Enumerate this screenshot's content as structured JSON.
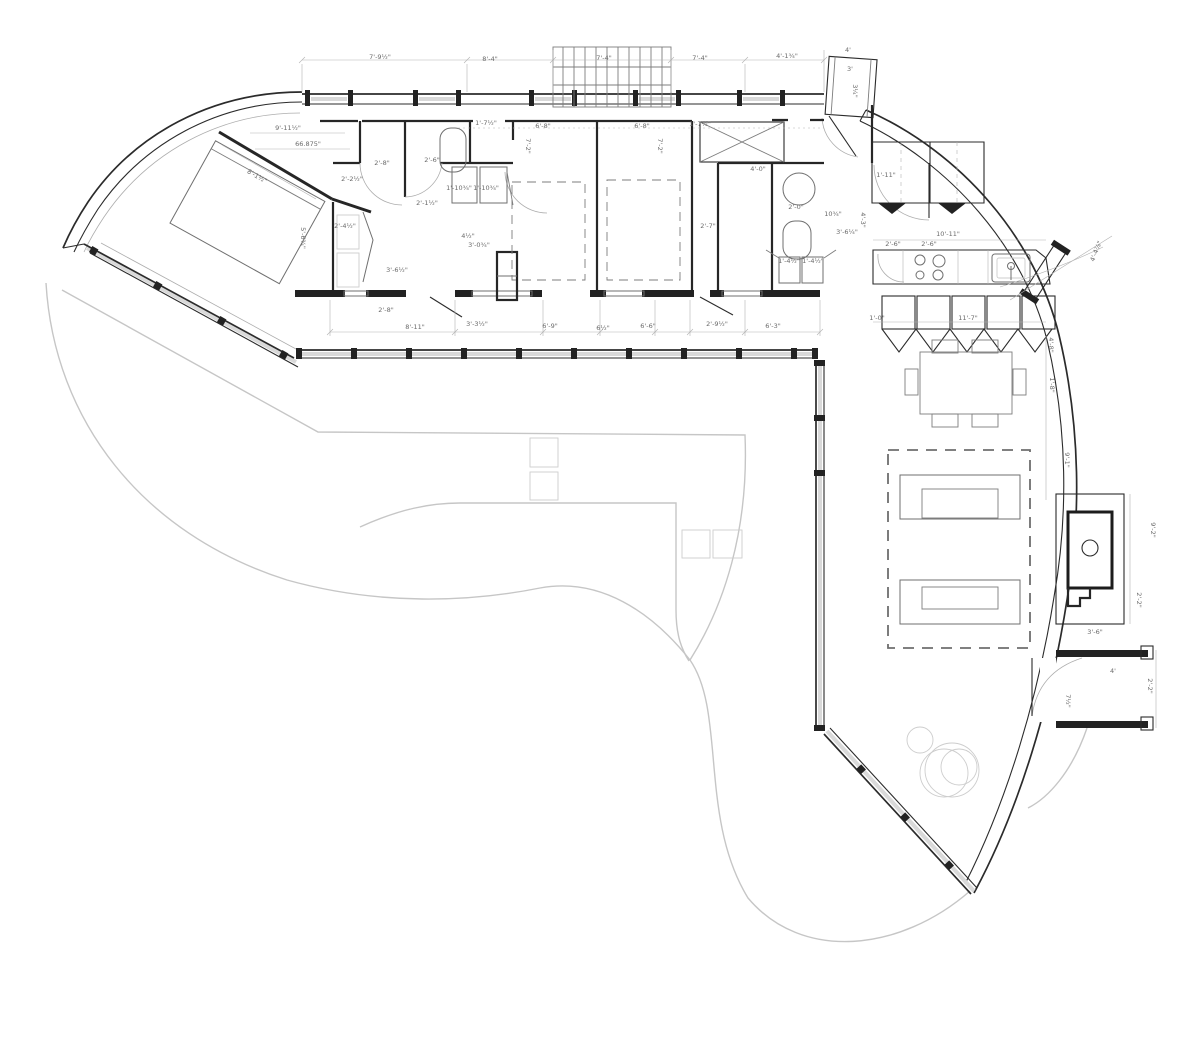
{
  "drawing": {
    "type": "architectural-floor-plan",
    "sheet_background": "#ffffff",
    "palette": {
      "wall_ink": "#2b2b2b",
      "fixture_gray": "#6f6f6f",
      "dimension_gray": "#b2b2b2",
      "terrace_gray": "#c6c6c6",
      "glass_gray": "#d9d9d9",
      "label_gray": "#6a6a6a"
    },
    "dimension_labels": [
      {
        "text": "7'-9½\"",
        "x": 380,
        "y": 59
      },
      {
        "text": "8'-4\"",
        "x": 490,
        "y": 61
      },
      {
        "text": "7'-4\"",
        "x": 604,
        "y": 60
      },
      {
        "text": "7'-4\"",
        "x": 700,
        "y": 60
      },
      {
        "text": "4'-1¾\"",
        "x": 787,
        "y": 58
      },
      {
        "text": "4'",
        "x": 848,
        "y": 52
      },
      {
        "text": "3'",
        "x": 850,
        "y": 71
      },
      {
        "text": "3¼\"",
        "x": 853,
        "y": 91,
        "rot": 90
      },
      {
        "text": "9'-11½\"",
        "x": 288,
        "y": 130
      },
      {
        "text": "66.875\"",
        "x": 308,
        "y": 146
      },
      {
        "text": "1'-7½\"",
        "x": 486,
        "y": 125
      },
      {
        "text": "6'-8\"",
        "x": 543,
        "y": 128
      },
      {
        "text": "6'-8\"",
        "x": 642,
        "y": 128
      },
      {
        "text": "1'-7½\"",
        "x": 700,
        "y": 126
      },
      {
        "text": "7'-2\"",
        "x": 526,
        "y": 146,
        "rot": 90
      },
      {
        "text": "7'-2\"",
        "x": 658,
        "y": 146,
        "rot": 90
      },
      {
        "text": "2'-8\"",
        "x": 382,
        "y": 165
      },
      {
        "text": "2'-6\"",
        "x": 432,
        "y": 162
      },
      {
        "text": "1'-10¾\"",
        "x": 459,
        "y": 190
      },
      {
        "text": "1'-10¾\"",
        "x": 486,
        "y": 190
      },
      {
        "text": "2'-1½\"",
        "x": 427,
        "y": 205
      },
      {
        "text": "2'-2½\"",
        "x": 352,
        "y": 181
      },
      {
        "text": "2'-4½\"",
        "x": 345,
        "y": 228
      },
      {
        "text": "5'-6¾\"",
        "x": 301,
        "y": 238,
        "rot": 90
      },
      {
        "text": "3'-6½\"",
        "x": 397,
        "y": 272
      },
      {
        "text": "4½\"",
        "x": 468,
        "y": 238
      },
      {
        "text": "3'-0¾\"",
        "x": 479,
        "y": 247
      },
      {
        "text": "8'-1½\"",
        "x": 256,
        "y": 178,
        "rot": 30
      },
      {
        "text": "2'-8\"",
        "x": 386,
        "y": 312
      },
      {
        "text": "8'-11\"",
        "x": 415,
        "y": 329
      },
      {
        "text": "3'-3½\"",
        "x": 477,
        "y": 326
      },
      {
        "text": "6'-9\"",
        "x": 550,
        "y": 328
      },
      {
        "text": "6½\"",
        "x": 603,
        "y": 330
      },
      {
        "text": "6'-6\"",
        "x": 648,
        "y": 328
      },
      {
        "text": "2'-9½\"",
        "x": 717,
        "y": 326
      },
      {
        "text": "6'-3\"",
        "x": 773,
        "y": 328
      },
      {
        "text": "2'-7\"",
        "x": 708,
        "y": 228
      },
      {
        "text": "4'-0\"",
        "x": 758,
        "y": 171
      },
      {
        "text": "2'-0\"",
        "x": 796,
        "y": 209
      },
      {
        "text": "1'-4½\"",
        "x": 789,
        "y": 263
      },
      {
        "text": "1'-4½\"",
        "x": 813,
        "y": 263
      },
      {
        "text": "10¾\"",
        "x": 833,
        "y": 216
      },
      {
        "text": "3'-6¼\"",
        "x": 847,
        "y": 234
      },
      {
        "text": "1'-11\"",
        "x": 886,
        "y": 177
      },
      {
        "text": "10'-11\"",
        "x": 948,
        "y": 236
      },
      {
        "text": "2'-6\"",
        "x": 893,
        "y": 246
      },
      {
        "text": "2'-6\"",
        "x": 929,
        "y": 246
      },
      {
        "text": "4'-3\"",
        "x": 861,
        "y": 220,
        "rot": 90
      },
      {
        "text": "11'-7\"",
        "x": 968,
        "y": 320
      },
      {
        "text": "1'-0\"",
        "x": 877,
        "y": 320
      },
      {
        "text": "4'-4⅞\"",
        "x": 1098,
        "y": 252,
        "rot": -68
      },
      {
        "text": "4'-8\"",
        "x": 1049,
        "y": 345,
        "rot": 90
      },
      {
        "text": "1'-8\"",
        "x": 1050,
        "y": 385,
        "rot": 90
      },
      {
        "text": "9'-1\"",
        "x": 1065,
        "y": 460,
        "rot": 90
      },
      {
        "text": "9'-2\"",
        "x": 1151,
        "y": 530,
        "rot": 90
      },
      {
        "text": "2'-2\"",
        "x": 1137,
        "y": 600,
        "rot": 90
      },
      {
        "text": "3'-6\"",
        "x": 1095,
        "y": 634
      },
      {
        "text": "4'",
        "x": 1113,
        "y": 673
      },
      {
        "text": "2'-2\"",
        "x": 1148,
        "y": 686,
        "rot": 90
      },
      {
        "text": "7½\"",
        "x": 1066,
        "y": 701,
        "rot": 90
      }
    ]
  }
}
